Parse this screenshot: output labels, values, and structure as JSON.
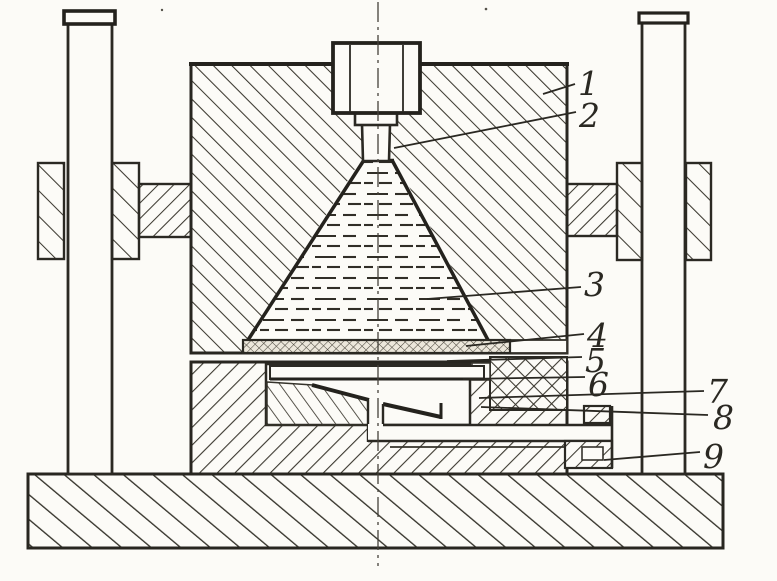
{
  "figure": {
    "kind": "sectional-technical-drawing",
    "paper_color": "#fcfbf7",
    "ink_color": "#2a2822",
    "callouts": [
      {
        "label": "1"
      },
      {
        "label": "2"
      },
      {
        "label": "3"
      },
      {
        "label": "4"
      },
      {
        "label": "5"
      },
      {
        "label": "6"
      },
      {
        "label": "7"
      },
      {
        "label": "8"
      },
      {
        "label": "9"
      }
    ]
  }
}
